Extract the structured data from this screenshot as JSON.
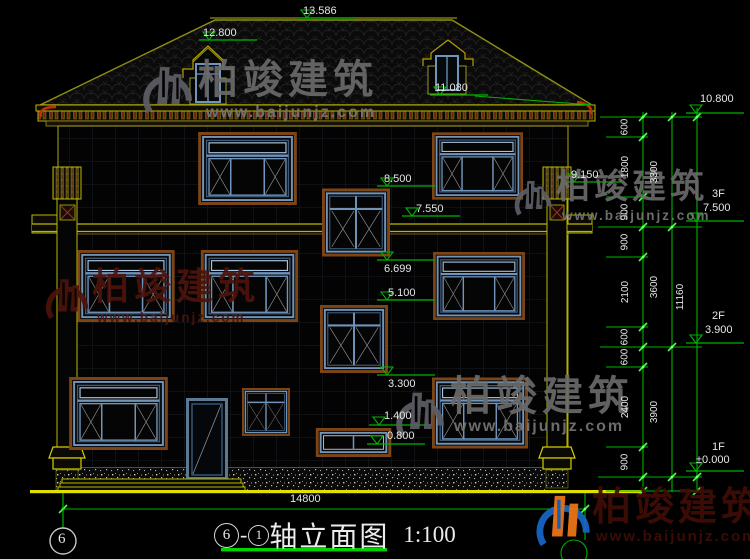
{
  "title": {
    "axis_from": "6",
    "dash": "-",
    "axis_to": "1",
    "text": "轴立面图",
    "scale": "1:100"
  },
  "axis_bubble_left": "6",
  "watermark": {
    "brand": "柏竣建筑",
    "site": "www.baijunjz.com"
  },
  "dims": {
    "width_total": "14800",
    "height_total": "11160",
    "chain_small": [
      "600",
      "1800",
      "900",
      "900",
      "2100",
      "600",
      "600",
      "2400",
      "900"
    ],
    "chain_floor": [
      "3300",
      "3600",
      "3900"
    ]
  },
  "levels": {
    "facade": [
      "13.586",
      "12.800",
      "11.080",
      "9.150",
      "8.500",
      "7.550",
      "6.699",
      "5.100",
      "3.300",
      "1.400",
      "0.800"
    ],
    "right": [
      {
        "floor": "",
        "value": "10.800"
      },
      {
        "floor": "3F",
        "value": "7.500"
      },
      {
        "floor": "2F",
        "value": "3.900"
      },
      {
        "floor": "1F",
        "value": "±0.000"
      }
    ]
  },
  "colors": {
    "dimension_green": "#00b400",
    "tick_green": "#4cff4c",
    "ground_yellow": "#e0e000",
    "line_yellow": "#b8b800",
    "roof_olive": "#8f8f15",
    "frame_brown": "#7d4516",
    "sash_blue": "#7195ba",
    "red_accent": "#c23010",
    "watermark_gray": "#6a6a6a",
    "watermark_dark_red": "#4e130b",
    "logo_blue": "#1868c8",
    "logo_orange": "#f07818"
  }
}
